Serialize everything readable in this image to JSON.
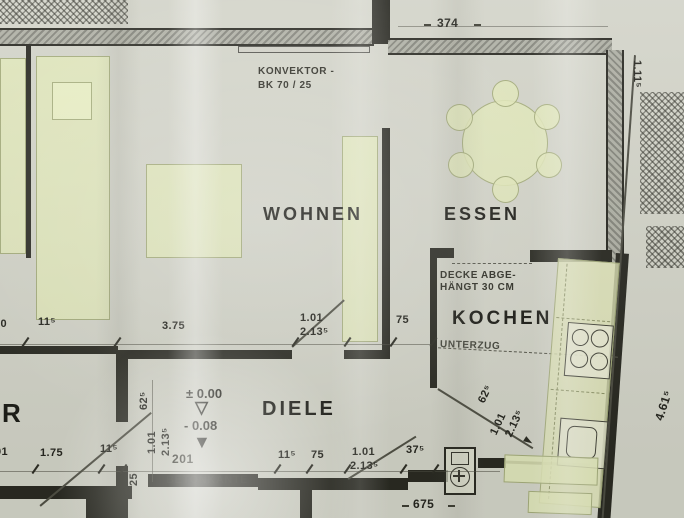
{
  "rooms": {
    "wohnen": "WOHNEN",
    "essen": "ESSEN",
    "kochen": "KOCHEN",
    "diele": "DIELE",
    "left_room_fragment": "R"
  },
  "notes": {
    "konvektor_line1": "KONVEKTOR -",
    "konvektor_line2": "BK 70 / 25",
    "decke_line1": "DECKE ABGE-",
    "decke_line2": "HÄNGT 30 CM",
    "unterzug": "UNTERZUG",
    "beton_number": "201",
    "betonkante": "BETONKANTE"
  },
  "levels": {
    "upper": "± 0.00",
    "upper_symbol": "▽",
    "lower": "- 0.08",
    "lower_symbol": "▼"
  },
  "dimensions": {
    "top_width": "374",
    "bottom_width": "675",
    "mid_chain": [
      "50",
      "11⁵",
      "3.75",
      "1.01",
      "2.13⁵",
      "75"
    ],
    "bottom_chain": [
      "01",
      "1.75",
      "11⁵",
      "11⁵",
      "75",
      "1.01",
      "2.13⁵",
      "37⁵"
    ],
    "left_vertical": [
      "62⁵",
      "1.01",
      "2.13⁵",
      "25"
    ],
    "kochen_door": [
      "62⁵",
      "1.01",
      "2.13⁵"
    ],
    "right_height": "4.61⁵",
    "right_top": "1.11⁵"
  },
  "colors": {
    "paper": "#d2d3c8",
    "line": "#26261f",
    "wall_fill": "#aeafa4",
    "furniture": "#e2e7b8"
  }
}
